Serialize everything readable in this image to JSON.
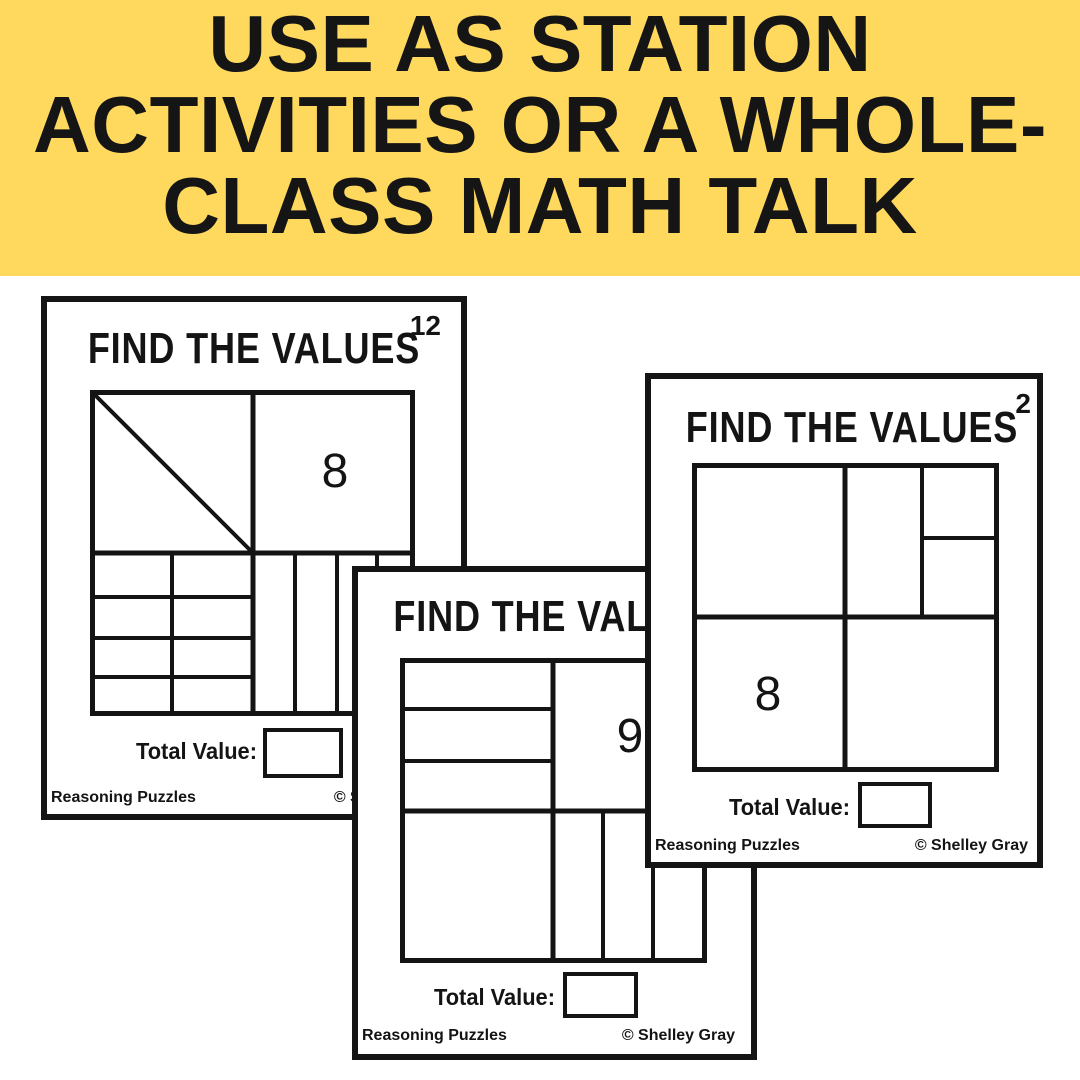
{
  "banner": {
    "lines": [
      "USE AS STATION",
      "ACTIVITIES OR A WHOLE-",
      "CLASS MATH TALK"
    ],
    "background_color": "#FFD95E",
    "text_color": "#151515"
  },
  "cards": {
    "left": {
      "title": "FIND THE VALUES",
      "number": "12",
      "cell_value": "8",
      "total_label": "Total Value:",
      "footer_left": "Reasoning Puzzles",
      "footer_right": "© Shelley Gray"
    },
    "middle": {
      "title": "FIND THE VALUES",
      "cell_value": "9",
      "total_label": "Total Value:",
      "footer_left": "Reasoning Puzzles",
      "footer_right": "© Shelley Gray"
    },
    "right": {
      "title": "FIND THE VALUES",
      "number": "2",
      "cell_value": "8",
      "total_label": "Total Value:",
      "footer_left": "Reasoning Puzzles",
      "footer_right": "© Shelley Gray"
    }
  },
  "ink_color": "#141414"
}
